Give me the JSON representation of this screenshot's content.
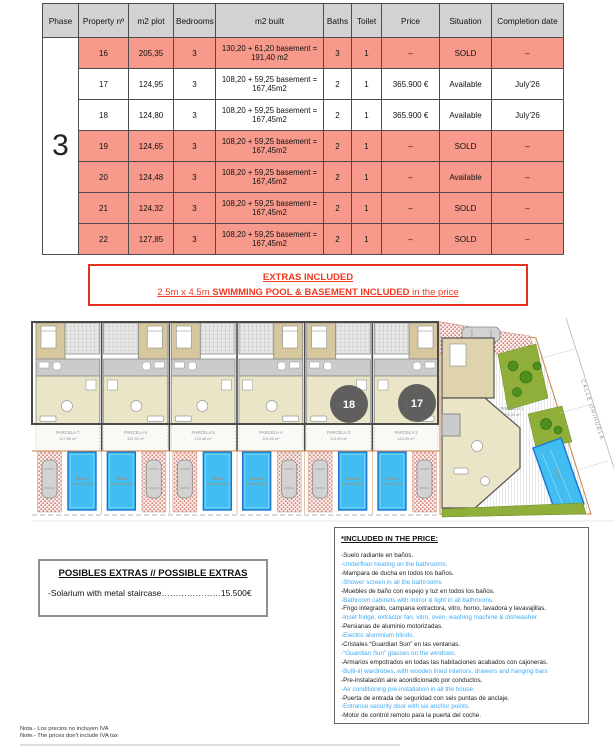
{
  "table": {
    "phase": "3",
    "headers": [
      "Phase",
      "Property nº",
      "m2 plot",
      "Bedrooms",
      "m2 built",
      "Baths",
      "Toilet",
      "Price",
      "Situation",
      "Completion date"
    ],
    "rows": [
      {
        "property": "16",
        "plot": "205,35",
        "bedrooms": "3",
        "built": "130,20 + 61,20 basement =\n191,40 m2",
        "baths": "3",
        "toilet": "1",
        "price": "–",
        "situation": "SOLD",
        "completion": "–",
        "highlight": true
      },
      {
        "property": "17",
        "plot": "124,95",
        "bedrooms": "3",
        "built": "108,20 + 59,25 basement =\n167,45m2",
        "baths": "2",
        "toilet": "1",
        "price": "365.900 €",
        "situation": "Available",
        "completion": "July'26",
        "highlight": false
      },
      {
        "property": "18",
        "plot": "124,80",
        "bedrooms": "3",
        "built": "108,20 + 59,25 basement =\n167,45m2",
        "baths": "2",
        "toilet": "1",
        "price": "365.900 €",
        "situation": "Available",
        "completion": "July'26",
        "highlight": false
      },
      {
        "property": "19",
        "plot": "124,65",
        "bedrooms": "3",
        "built": "108,20 + 59,25 basement =\n167,45m2",
        "baths": "2",
        "toilet": "1",
        "price": "–",
        "situation": "SOLD",
        "completion": "–",
        "highlight": true
      },
      {
        "property": "20",
        "plot": "124,48",
        "bedrooms": "3",
        "built": "108,20 + 59,25 basement =\n167,45m2",
        "baths": "2",
        "toilet": "1",
        "price": "–",
        "situation": "Available",
        "completion": "–",
        "highlight": true
      },
      {
        "property": "21",
        "plot": "124,32",
        "bedrooms": "3",
        "built": "108,20 + 59,25 basement =\n167,45m2",
        "baths": "2",
        "toilet": "1",
        "price": "–",
        "situation": "SOLD",
        "completion": "–",
        "highlight": true
      },
      {
        "property": "22",
        "plot": "127,85",
        "bedrooms": "3",
        "built": "108,20 + 59,25 basement =\n167,45m2",
        "baths": "2",
        "toilet": "1",
        "price": "–",
        "situation": "SOLD",
        "completion": "–",
        "highlight": true
      }
    ],
    "colors": {
      "sold_row": "#f79a8b",
      "header_bg": "#d2d2d2"
    }
  },
  "extras_included": {
    "title": "EXTRAS INCLUDED",
    "line2_prefix": "2.5m x 4.5m ",
    "line2_bold": "SWIMMING POOL & BASEMENT INCLUDED",
    "line2_suffix": " in the price",
    "accent_color": "#f13a22"
  },
  "site_plan": {
    "badges": [
      "18",
      "17"
    ],
    "street": "CALLE ORIHUELA",
    "pool_label": "PISCINA",
    "pool_sublabel": "S.Lámina: 15,00m²",
    "parcels": [
      {
        "name": "PARCELA 7",
        "area": "127,85 m²"
      },
      {
        "name": "PARCELA 6",
        "area": "124,32 m²"
      },
      {
        "name": "PARCELA 5",
        "area": "124,48 m²"
      },
      {
        "name": "PARCELA 4",
        "area": "124,65 m²"
      },
      {
        "name": "PARCELA 3",
        "area": "124,80 m²"
      },
      {
        "name": "PARCELA 2",
        "area": "124,95 m²"
      }
    ],
    "corner_parcel": {
      "name": "PARCELA 1",
      "area": "205,35 m²"
    },
    "colors": {
      "pool": "#41bdf1",
      "garden": "#8fae3a",
      "living": "#eae5c6",
      "bedroom": "#d6c79c"
    }
  },
  "possible_extras": {
    "title": "POSIBLES EXTRAS  //  POSSIBLE EXTRAS",
    "items": [
      "-Solarium with metal staircase…………………15.500€"
    ]
  },
  "included_in_price": {
    "title": "*INCLUDED IN THE PRICE:",
    "en_color": "#3fa9f5",
    "items": [
      {
        "text": "-Suelo radiante en baños.",
        "en": false
      },
      {
        "text": "-Underfloor heating on the bathrooms.",
        "en": true
      },
      {
        "text": "-Mampara de ducha en todos los baños.",
        "en": false
      },
      {
        "text": "-Shower screen in all the bathrooms",
        "en": true
      },
      {
        "text": "-Muebles de baño con espejo y luz en todos los baños.",
        "en": false
      },
      {
        "text": "-Bathroom cabinets with mirror & light in all bathrooms.",
        "en": true
      },
      {
        "text": "-Frigo integrado, campana extractora, vitro, horno, lavadora y lavavajillas.",
        "en": false
      },
      {
        "text": "-Inset fridge, extractor fan, vitro, oven, washing machine & dishwasher.",
        "en": true
      },
      {
        "text": "-Persianas de aluminio motorizadas.",
        "en": false
      },
      {
        "text": "-Electric aluminium blinds.",
        "en": true
      },
      {
        "text": "-Cristales “Guardian Sun” en las ventanas.",
        "en": false
      },
      {
        "text": "-“Guardian Sun” glasses on the windows.",
        "en": true
      },
      {
        "text": "-Armarios empotrados en todas las habitaciones acabados con cajoneras.",
        "en": false
      },
      {
        "text": "-Built-in wardrobes, with wooden lined interiors, drawers and hanging bars",
        "en": true
      },
      {
        "text": "-Pre-instalación aire acondicionado por conductos.",
        "en": false
      },
      {
        "text": "-Air conditioning pre-installation in all the house.",
        "en": true
      },
      {
        "text": "-Puerta de entrada de seguridad con seis puntas de anclaje.",
        "en": false
      },
      {
        "text": "-Entrance security door with six anchor points.",
        "en": true
      },
      {
        "text": "-Motor de control remoto para la puerta del coche.",
        "en": false
      }
    ]
  },
  "notes": [
    "Nota.- Los precios no incluyen IVA",
    "Note.- The prices don't include IVA tax"
  ]
}
